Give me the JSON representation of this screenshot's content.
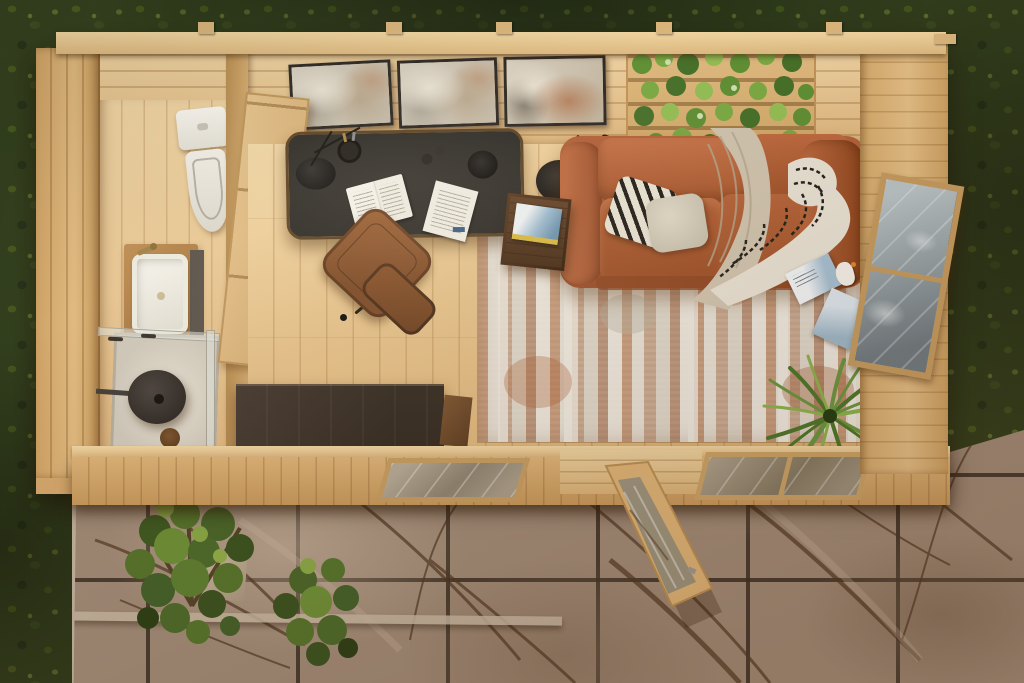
{
  "scene": {
    "aria_label": "Aerial top-down 3D rendering of a one-room wooden garden cabin with a bathroom, home office and lounge, surrounded by a lawn and a marble-tiled patio",
    "view": "top-down aerial, roof removed",
    "palette": {
      "grass_green": "#33401e",
      "marble_tile": "#9f8a77",
      "marble_vein_brown": "#503823",
      "wood_wall_pine": "#dcb27a",
      "wood_floor_pine": "#e5c18a",
      "wood_trim_dark": "#b78d52",
      "desk_top_charcoal": "#2b2825",
      "sofa_rust": "#b2613a",
      "leather_chair_brown": "#8a5129",
      "sideboard_espresso": "#332920",
      "rug_base_cream": "#d9d1c3",
      "rug_accent_rust": "#b06a3e",
      "ceramic_white": "#f4f1ea",
      "plant_green": "#5f8f35",
      "glass_grey": "#96a2a7",
      "throw_beige": "#cfc3ae",
      "pillow_black_white": "#231f1a",
      "book_cover_blue": "#9fbdd2"
    },
    "exterior": {
      "ground": "lawn grass",
      "patio": "large-format marble-look tiles with brown veining and a step",
      "plants": [
        "patio shrub large",
        "patio shrub small"
      ],
      "structure": [
        "roof top plate",
        "rafter stubs"
      ]
    },
    "rooms": {
      "bathroom": {
        "fixtures": [
          "toilet",
          "wooden vanity with white vessel sink and brass faucet",
          "walk-in glass shower with round rain head and floor drain"
        ],
        "openings": [
          "left wall window",
          "wooden door to main room"
        ]
      },
      "office": {
        "furniture": [
          "charcoal-top desk with wood rim",
          "brown leather office chair",
          "dark espresso sideboard"
        ],
        "desk_items": [
          "black desk lamp",
          "pen cup",
          "open book",
          "loose document",
          "black mug",
          "two small bottles"
        ]
      },
      "lounge": {
        "furniture": [
          "rust-orange fabric sofa with chaise",
          "dark wood cube side table",
          "black arc floor lamp"
        ],
        "decor": [
          "distressed cream-and-rust area rug",
          "three framed abstract artworks",
          "pallet-style vertical plant wall",
          "black-and-white geometric pillow",
          "cream pillow",
          "beige throw blanket",
          "black-and-white patterned throw",
          "spiky potted plant",
          "magazines leaning on window",
          "white bird ornament",
          "blue book on side table"
        ],
        "openings": [
          "bottom wall window left",
          "bottom wall window right",
          "open glazed patio door",
          "right wall window"
        ]
      }
    }
  }
}
